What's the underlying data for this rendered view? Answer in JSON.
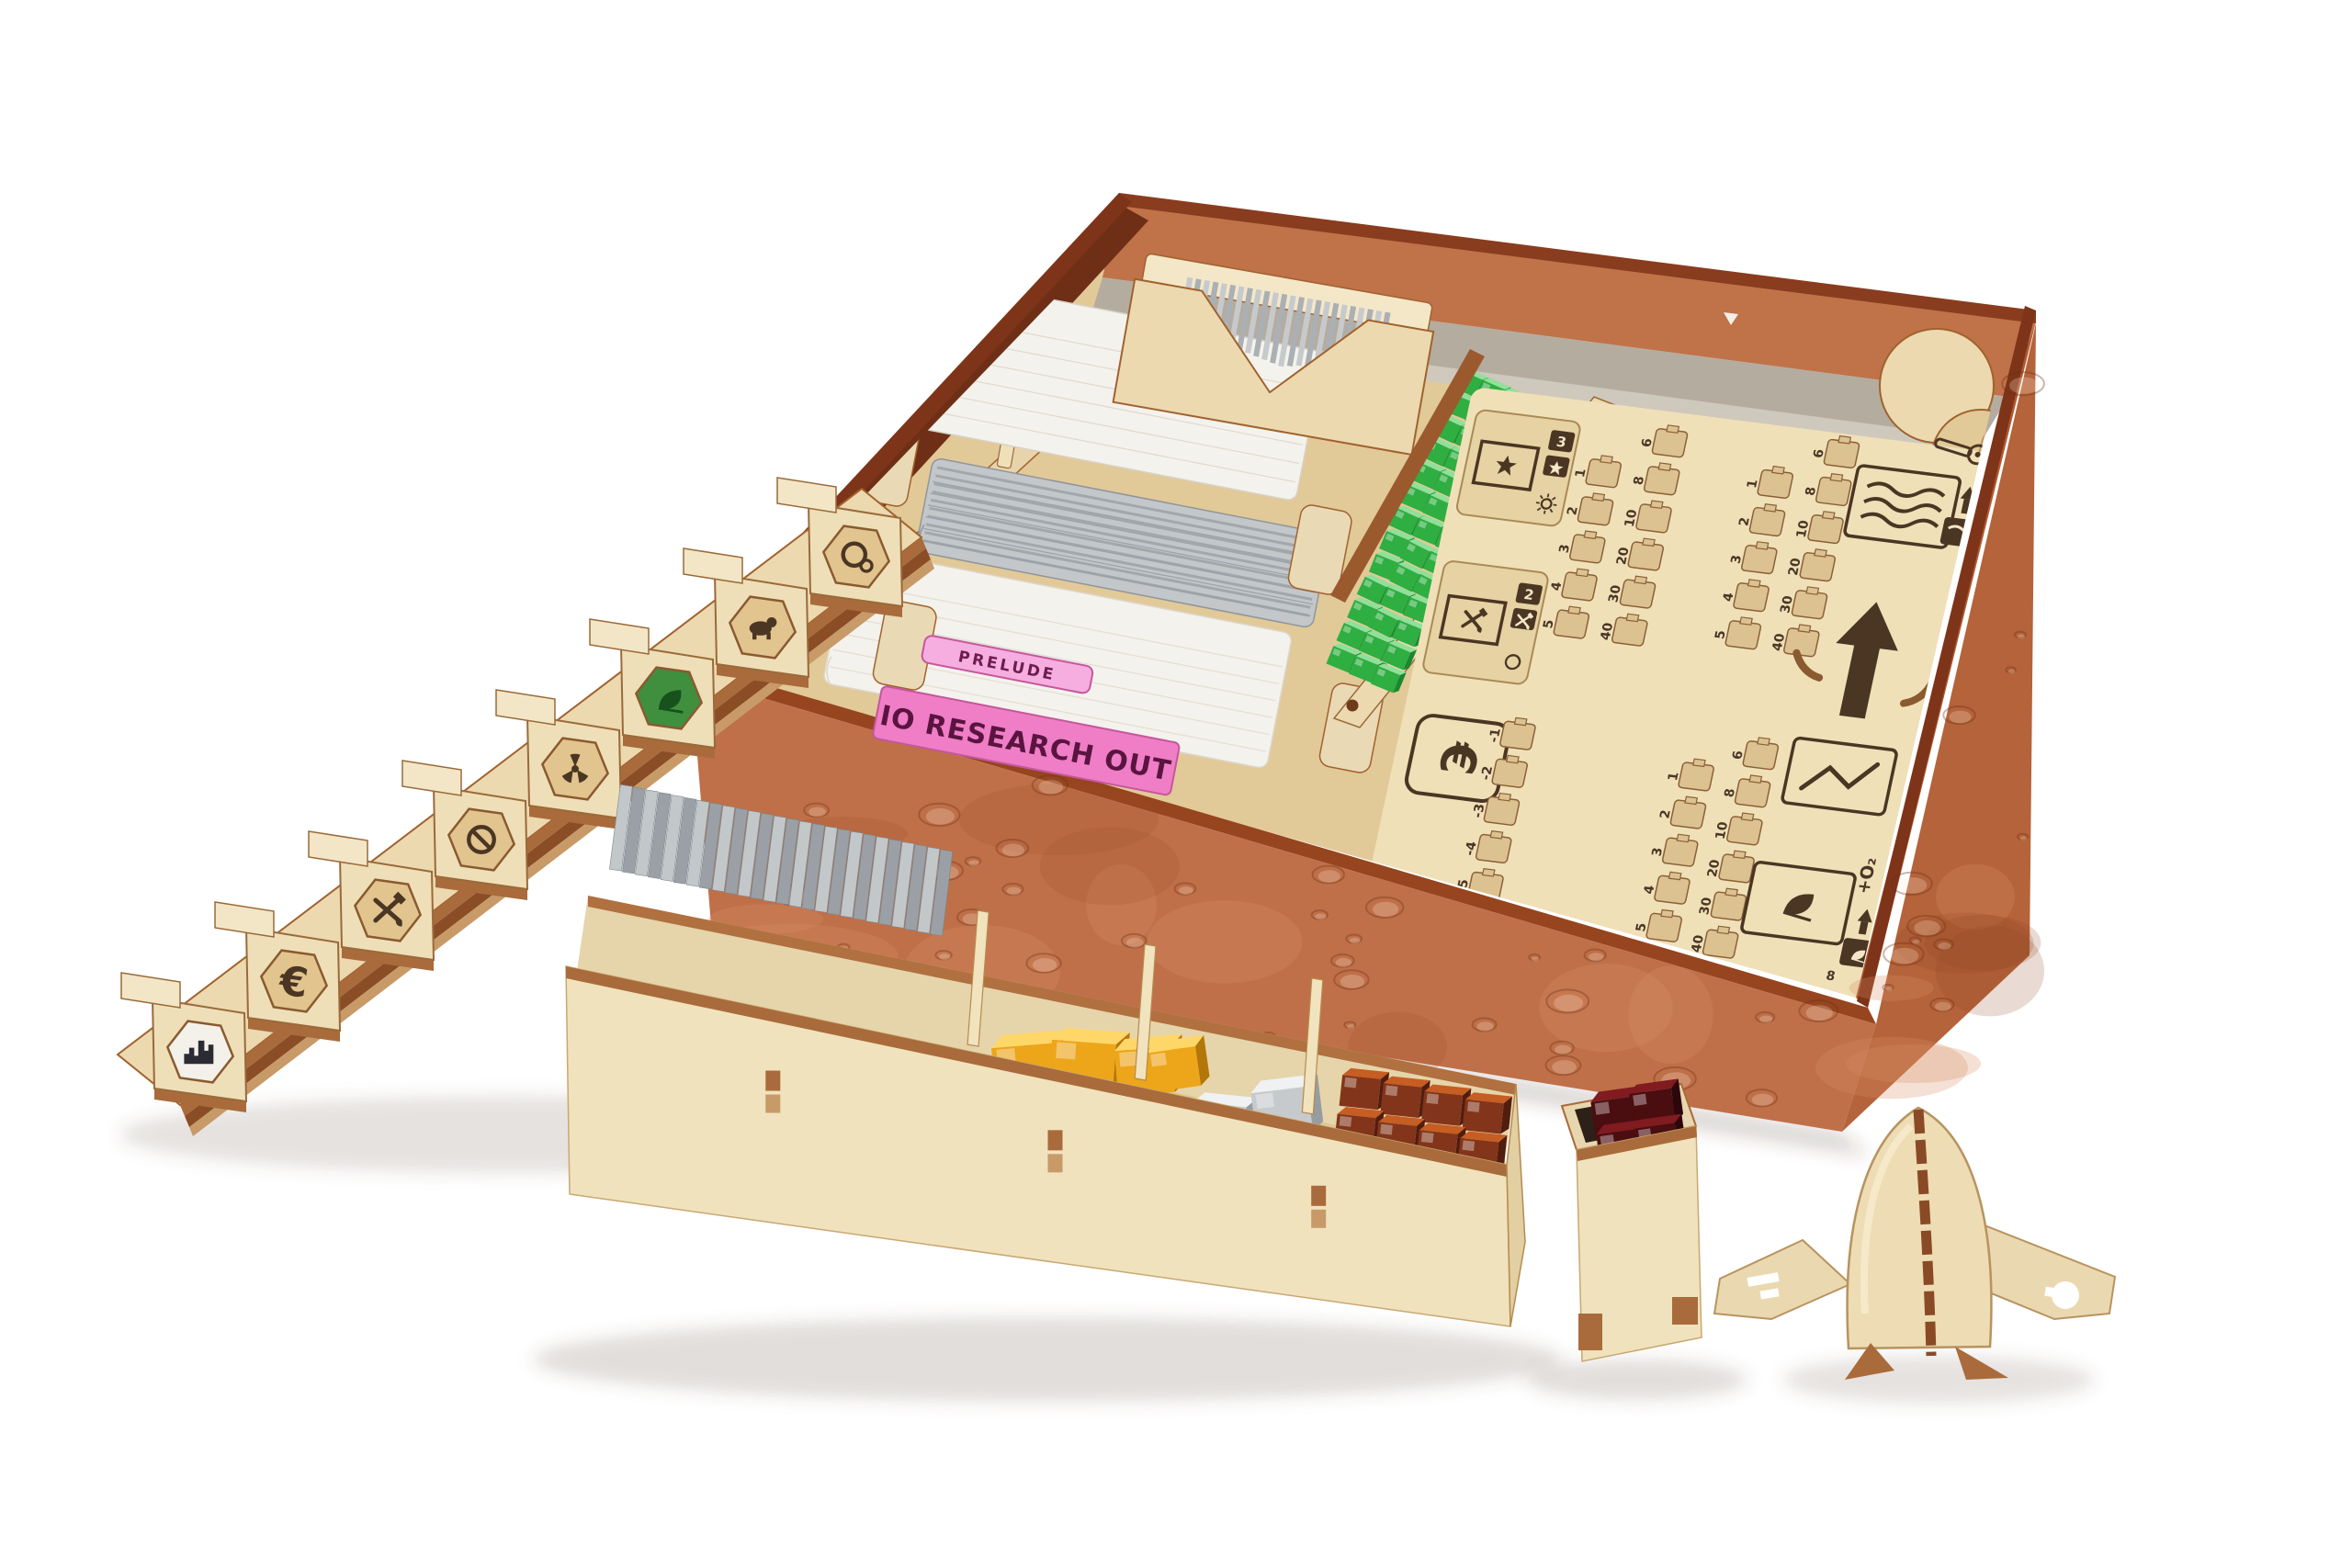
{
  "product": {
    "description": "Laser-cut plywood board game organizer inside a Mars-textured game box, with card wells, cube trays, hex tile rack, resource tray and a rocket standee"
  },
  "palette": {
    "background": "#ffffff",
    "box_face": "#bf7048",
    "box_face_light": "#d28a5e",
    "box_face_dark": "#9c4f28",
    "box_rim": "#8a3c1f",
    "box_rim_dark": "#7e3418",
    "box_left_wall": "#6e2f16",
    "box_inner_back": "#c07248",
    "liner_gray": "#b5aca0",
    "plywood": "#ecd9af",
    "plywood_light": "#f4e7c8",
    "plywood_mid": "#e2c998",
    "plywood_shade": "#d7bb8a",
    "wood_edge": "#a0622f",
    "wood_edge_dark": "#7e4a20",
    "etch": "#4b3624",
    "card_white": "#f4f2ec",
    "card_gray": "#a7adb2",
    "pink": "#ef7ec6",
    "pink_dark": "#6e1c50",
    "green_cube": "#2fae41",
    "green_cube_dark": "#1d8630",
    "green_cube_light": "#8fe09a",
    "gold": "#eda51a",
    "gold_light": "#ffd768",
    "gold_dark": "#b27708",
    "silver": "#c6cacc",
    "silver_light": "#eff1f2",
    "silver_dark": "#969da1",
    "copper": "#82351a",
    "copper_light": "#c65d22",
    "copper_dark": "#511d0e",
    "dark_red": "#4a0d10",
    "dark_red_light": "#801b20",
    "tile_gray": "#aab0b4",
    "tile_gray_light": "#c6cacd"
  },
  "cards": {
    "prelude_tab": "PRELUDE",
    "pink_card_title": "IO RESEARCH OUT",
    "stacks": [
      "white-card-stack",
      "gray-card-stack",
      "white-card-stack"
    ]
  },
  "panel": {
    "zones": {
      "milestone": {
        "icon": "star",
        "count": "3"
      },
      "projects": {
        "icon": "crossed-tools",
        "count": "2"
      },
      "megacredit": {
        "symbol": "€"
      },
      "ocean": {
        "icon": "waves"
      },
      "temperature": {
        "icon": "thermometer"
      },
      "arrow": {
        "icon": "arrow-up"
      },
      "power": {
        "icon": "zigzag"
      },
      "greenery": {
        "icon": "leaf",
        "oxygen": "+O₂",
        "chip": "8"
      }
    },
    "tracks": {
      "low": [
        "1",
        "2",
        "3",
        "4",
        "5"
      ],
      "high": [
        "6",
        "8",
        "10",
        "20",
        "30",
        "40"
      ],
      "negative": [
        "-1",
        "-2",
        "-3",
        "-4",
        "-5"
      ]
    }
  },
  "tile_rack": {
    "euro": "€",
    "tiles": [
      "orbit-ring",
      "animal",
      "greenery",
      "radiation",
      "restricted",
      "mining",
      "commerce-euro",
      "city"
    ]
  },
  "resource_tray": {
    "compartments": [
      {
        "name": "gray-hex-tile-stack",
        "count": 26
      },
      {
        "name": "gold-cubes",
        "count": 9
      },
      {
        "name": "silver-cubes",
        "count": 6
      },
      {
        "name": "copper-cubes",
        "count": 20
      }
    ]
  },
  "green_cubes": {
    "columns": 3,
    "rows": 13
  },
  "small_tray": {
    "name": "dark-red-cube-tray",
    "count": 4
  },
  "rocket": {
    "name": "rocket-standee"
  }
}
